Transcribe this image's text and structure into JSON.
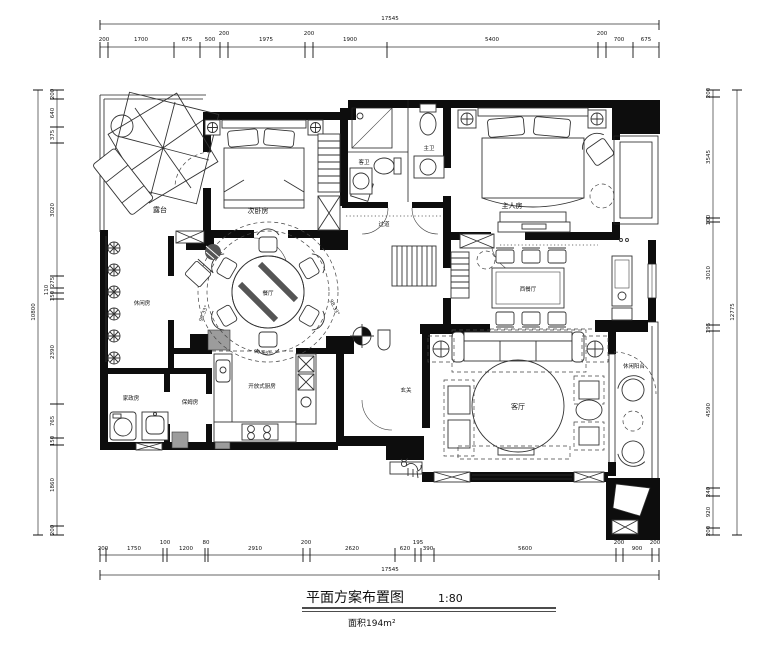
{
  "title_block": {
    "title": "平面方案布置图",
    "scale": "1:80",
    "area": "面积194m²"
  },
  "rooms": {
    "terrace": "露台",
    "bedroom2": "次卧房",
    "master_bedroom": "主人房",
    "guest_bath": "客卫",
    "master_bath": "主卫",
    "corridor": "过道",
    "dining_round": "餐厅",
    "dining_west": "西餐厅",
    "leisure_room": "休闲房",
    "utility_room": "家政房",
    "maid_room": "保姆房",
    "kitchen": "开放式厨房",
    "entry": "玄关",
    "living_room": "客厅",
    "leisure_balcony": "休闲阳台"
  },
  "annotations": {
    "angle1": "98.33°",
    "angle2": "98.33°",
    "angle3": "90.53°"
  },
  "dimensions": {
    "top": {
      "values": [
        "200",
        "1700",
        "675",
        "500",
        "200",
        "1975",
        "200",
        "1900",
        "5400",
        "200",
        "700",
        "675"
      ],
      "total": "17545"
    },
    "bottom": {
      "values": [
        "200",
        "1750",
        "100",
        "1200",
        "80",
        "2910",
        "200",
        "2620",
        "620",
        "195",
        "390",
        "5600",
        "200",
        "900",
        "200"
      ],
      "total": "17545"
    },
    "left": {
      "values": [
        "200",
        "640",
        "375",
        "3020",
        "275",
        "110",
        "150",
        "2390",
        "765",
        "150",
        "1860",
        "200"
      ],
      "total": "10800"
    },
    "right": {
      "values": [
        "200",
        "3545",
        "100",
        "3010",
        "195",
        "4590",
        "240",
        "920",
        "200"
      ],
      "total": "12775"
    }
  }
}
